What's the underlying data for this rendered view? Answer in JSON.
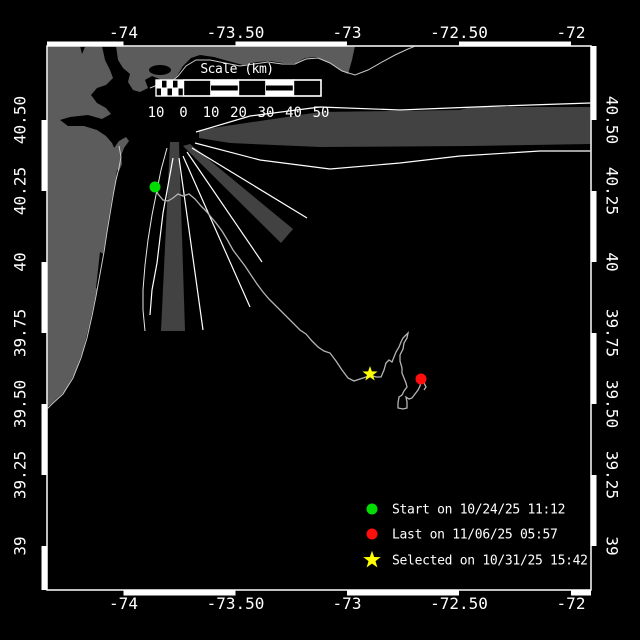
{
  "map": {
    "axes": {
      "lon_ticks": [
        {
          "label": "-74",
          "x": 123.5
        },
        {
          "label": "-73.50",
          "x": 235.5
        },
        {
          "label": "-73",
          "x": 347
        },
        {
          "label": "-72.50",
          "x": 459
        },
        {
          "label": "-72",
          "x": 571
        }
      ],
      "lat_ticks": [
        {
          "label": "40.50",
          "y": 120
        },
        {
          "label": "40.25",
          "y": 191
        },
        {
          "label": "40",
          "y": 262
        },
        {
          "label": "39.75",
          "y": 333
        },
        {
          "label": "39.50",
          "y": 404
        },
        {
          "label": "39.25",
          "y": 475
        },
        {
          "label": "39",
          "y": 546
        }
      ]
    },
    "scale_bar": {
      "title": "Scale (km)",
      "tick_labels": [
        "10",
        "0",
        "10",
        "20",
        "30",
        "40",
        "50"
      ],
      "tick_x": [
        156,
        183.5,
        211,
        238.5,
        266,
        293.5,
        321
      ]
    },
    "legend": {
      "items": [
        {
          "id": "start",
          "marker": "circle",
          "color": "#00dd00",
          "label": "Start on 10/24/25 11:12"
        },
        {
          "id": "last",
          "marker": "circle",
          "color": "#ff0e0e",
          "label": "Last on 11/06/25 05:57"
        },
        {
          "id": "selected",
          "marker": "star",
          "color": "#ffff00",
          "label": "Selected on 10/31/25 15:42"
        }
      ]
    },
    "track": {
      "points": [
        [
          155,
          187
        ],
        [
          158,
          194
        ],
        [
          163,
          200
        ],
        [
          168,
          201
        ],
        [
          173,
          198
        ],
        [
          178,
          194
        ],
        [
          183,
          196
        ],
        [
          189,
          194
        ],
        [
          195,
          199
        ],
        [
          201,
          206
        ],
        [
          206,
          211
        ],
        [
          211,
          217
        ],
        [
          216,
          223
        ],
        [
          222,
          231
        ],
        [
          228,
          241
        ],
        [
          233,
          250
        ],
        [
          239,
          258
        ],
        [
          245,
          266
        ],
        [
          251,
          275
        ],
        [
          257,
          284
        ],
        [
          263,
          292
        ],
        [
          269,
          299
        ],
        [
          275,
          305
        ],
        [
          281,
          311
        ],
        [
          288,
          318
        ],
        [
          294,
          324
        ],
        [
          300,
          330
        ],
        [
          306,
          334
        ],
        [
          312,
          341
        ],
        [
          318,
          347
        ],
        [
          324,
          351
        ],
        [
          330,
          353
        ],
        [
          336,
          361
        ],
        [
          342,
          370
        ],
        [
          348,
          378
        ],
        [
          354,
          381
        ],
        [
          360,
          379
        ],
        [
          366,
          377
        ],
        [
          370,
          375
        ],
        [
          376,
          377
        ],
        [
          381,
          377
        ],
        [
          384,
          370
        ],
        [
          386,
          363
        ],
        [
          389,
          360
        ],
        [
          392,
          362
        ],
        [
          394,
          357
        ],
        [
          396,
          352
        ],
        [
          399,
          347
        ],
        [
          401,
          342
        ],
        [
          403,
          338
        ],
        [
          406,
          335
        ],
        [
          408,
          333
        ],
        [
          407,
          338
        ],
        [
          404,
          343
        ],
        [
          403,
          349
        ],
        [
          400,
          355
        ],
        [
          400,
          361
        ],
        [
          402,
          368
        ],
        [
          402,
          373
        ],
        [
          404,
          378
        ],
        [
          406,
          383
        ],
        [
          407,
          387
        ],
        [
          404,
          391
        ],
        [
          402,
          395
        ],
        [
          399,
          397
        ],
        [
          398,
          403
        ],
        [
          398,
          408
        ],
        [
          403,
          409
        ],
        [
          407,
          408
        ],
        [
          407,
          402
        ],
        [
          406,
          397
        ],
        [
          409,
          399
        ],
        [
          412,
          398
        ],
        [
          415,
          394
        ],
        [
          418,
          390
        ],
        [
          420,
          386
        ],
        [
          421,
          381
        ],
        [
          421,
          379
        ],
        [
          424,
          383
        ],
        [
          426,
          387
        ],
        [
          424,
          390
        ]
      ],
      "markers": {
        "start": {
          "x": 155,
          "y": 187
        },
        "last": {
          "x": 421,
          "y": 379
        },
        "selected": {
          "x": 370,
          "y": 374
        }
      }
    },
    "colors": {
      "background": "#000000",
      "land": "#5c5c5c",
      "traffic_zone": "#424242",
      "lane_line": "#ffffff",
      "coastline": "#c9c9c9",
      "track": "#b4b4b4",
      "frame": "#ffffff"
    }
  }
}
